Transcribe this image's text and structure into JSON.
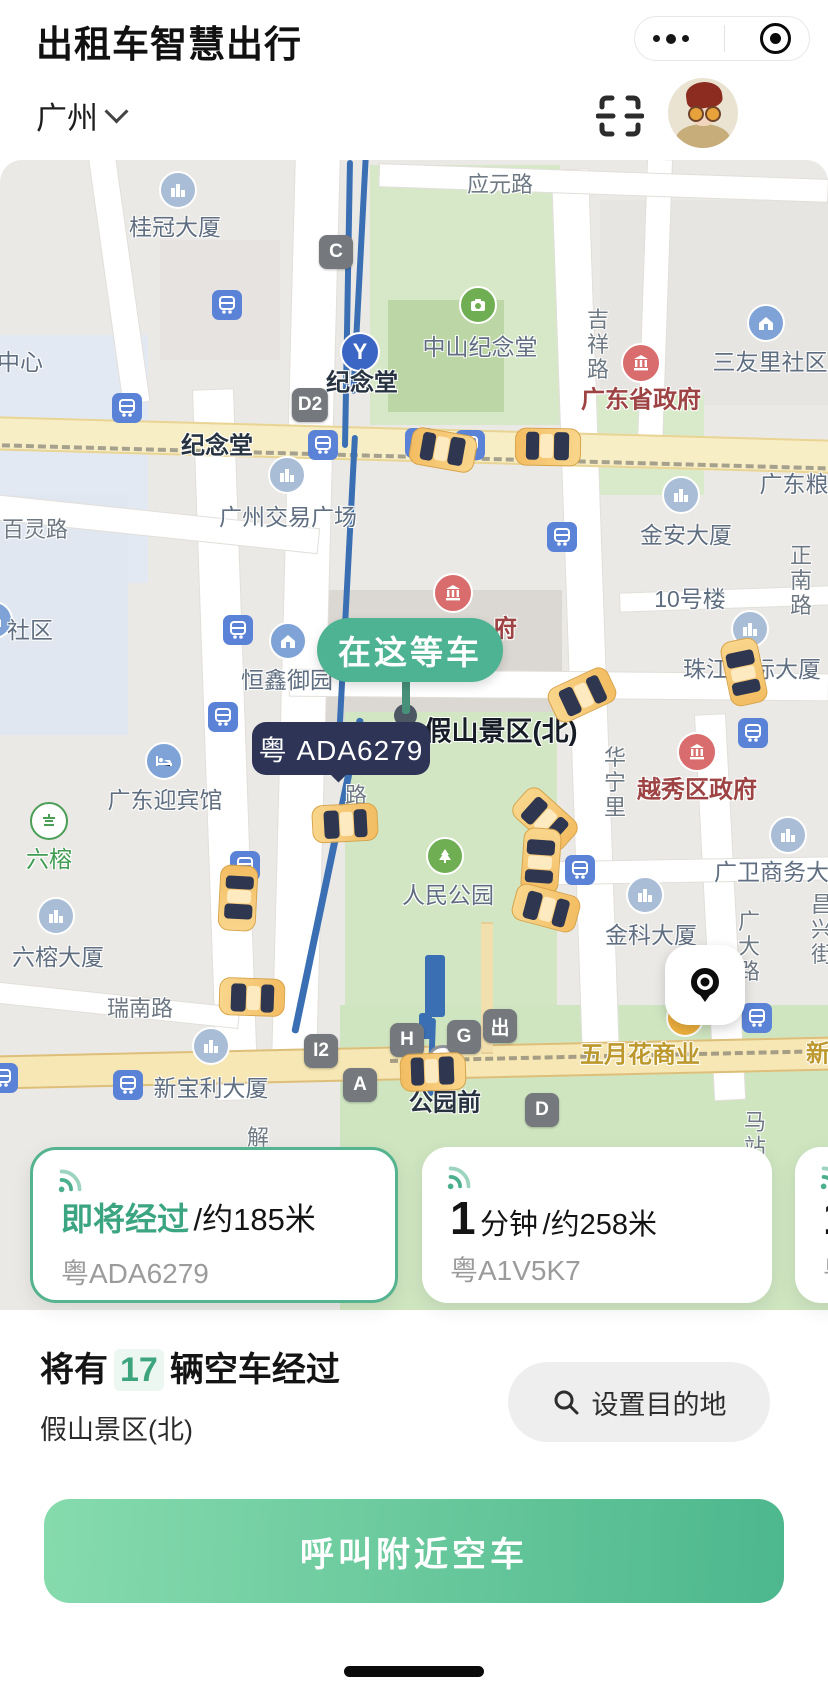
{
  "header": {
    "app_title": "出租车智慧出行",
    "city": "广州",
    "menu_dots": "more-menu",
    "exit_target": "exit-capsule"
  },
  "map": {
    "wait_pill": "在这等车",
    "plate_bubble": "粤 ADA6279",
    "labels": [
      {
        "t": "桂冠大厦",
        "x": 175,
        "y": 65,
        "ty": "poi"
      },
      {
        "t": "中心",
        "x": 20,
        "y": 200,
        "ty": "poi"
      },
      {
        "t": "应元路",
        "x": 500,
        "y": 23,
        "ty": "road"
      },
      {
        "t": "纪念堂",
        "x": 362,
        "y": 220,
        "ty": "station"
      },
      {
        "t": "纪念堂",
        "x": 217,
        "y": 283,
        "ty": "station"
      },
      {
        "t": "中山纪念堂",
        "x": 480,
        "y": 185,
        "ty": "poi"
      },
      {
        "t": "吉祥路",
        "x": 596,
        "y": 185,
        "ty": "road",
        "v": 1
      },
      {
        "t": "广东省政府",
        "x": 641,
        "y": 237,
        "ty": "gov"
      },
      {
        "t": "三友里社区",
        "x": 770,
        "y": 200,
        "ty": "poi"
      },
      {
        "t": "广东粮",
        "x": 794,
        "y": 322,
        "ty": "poi"
      },
      {
        "t": "广州交易广场",
        "x": 288,
        "y": 355,
        "ty": "poi"
      },
      {
        "t": "百灵路",
        "x": 35,
        "y": 368,
        "ty": "road"
      },
      {
        "t": "金安大厦",
        "x": 686,
        "y": 373,
        "ty": "poi"
      },
      {
        "t": "10号楼",
        "x": 690,
        "y": 437,
        "ty": "poi"
      },
      {
        "t": "正南路",
        "x": 799,
        "y": 421,
        "ty": "road",
        "v": 1
      },
      {
        "t": "珠江国际大厦",
        "x": 752,
        "y": 507,
        "ty": "poi"
      },
      {
        "t": "社区",
        "x": 30,
        "y": 468,
        "ty": "poi"
      },
      {
        "t": "恒鑫御园",
        "x": 287,
        "y": 518,
        "ty": "poi"
      },
      {
        "t": "府",
        "x": 505,
        "y": 466,
        "ty": "gov"
      },
      {
        "t": "假山景区(北)",
        "x": 501,
        "y": 569,
        "ty": "big"
      },
      {
        "t": "华宁里",
        "x": 613,
        "y": 623,
        "ty": "road",
        "v": 1
      },
      {
        "t": "越秀区政府",
        "x": 697,
        "y": 627,
        "ty": "gov"
      },
      {
        "t": "广东迎宾馆",
        "x": 165,
        "y": 638,
        "ty": "poi"
      },
      {
        "t": "六榕",
        "x": 49,
        "y": 697,
        "ty": "green"
      },
      {
        "t": "路",
        "x": 354,
        "y": 636,
        "ty": "road",
        "v": 1
      },
      {
        "t": "人民公园",
        "x": 448,
        "y": 733,
        "ty": "poi"
      },
      {
        "t": "广卫商务大厦",
        "x": 783,
        "y": 710,
        "ty": "poi"
      },
      {
        "t": "金科大厦",
        "x": 651,
        "y": 773,
        "ty": "poi"
      },
      {
        "t": "广大路",
        "x": 747,
        "y": 787,
        "ty": "road",
        "v": 1
      },
      {
        "t": "昌兴街",
        "x": 820,
        "y": 770,
        "ty": "road",
        "v": 1
      },
      {
        "t": "六榕大厦",
        "x": 58,
        "y": 795,
        "ty": "poi"
      },
      {
        "t": "瑞南路",
        "x": 140,
        "y": 847,
        "ty": "road"
      },
      {
        "t": "五月花商业",
        "x": 640,
        "y": 892,
        "ty": "gold"
      },
      {
        "t": "新",
        "x": 818,
        "y": 891,
        "ty": "gold"
      },
      {
        "t": "马站",
        "x": 753,
        "y": 975,
        "ty": "road",
        "v": 1
      },
      {
        "t": "新宝利大厦",
        "x": 211,
        "y": 926,
        "ty": "poi"
      },
      {
        "t": "解",
        "x": 258,
        "y": 976,
        "ty": "road"
      },
      {
        "t": "公园前",
        "x": 445,
        "y": 940,
        "ty": "station"
      }
    ],
    "badges": [
      {
        "t": "C",
        "x": 336,
        "y": 92
      },
      {
        "t": "D2",
        "x": 310,
        "y": 245
      },
      {
        "t": "I2",
        "x": 321,
        "y": 891
      },
      {
        "t": "H",
        "x": 407,
        "y": 880
      },
      {
        "t": "G",
        "x": 464,
        "y": 877
      },
      {
        "t": "出",
        "x": 500,
        "y": 866
      },
      {
        "t": "A",
        "x": 360,
        "y": 925
      },
      {
        "t": "D",
        "x": 542,
        "y": 950
      }
    ],
    "icons": [
      {
        "k": "metro",
        "x": 227,
        "y": 145
      },
      {
        "k": "metro",
        "x": 127,
        "y": 248
      },
      {
        "k": "metro",
        "x": 323,
        "y": 285
      },
      {
        "k": "metro",
        "x": 420,
        "y": 283
      },
      {
        "k": "metro",
        "x": 470,
        "y": 285
      },
      {
        "k": "metro",
        "x": 238,
        "y": 470
      },
      {
        "k": "metro",
        "x": 223,
        "y": 557
      },
      {
        "k": "metro",
        "x": 562,
        "y": 377
      },
      {
        "k": "metro",
        "x": 580,
        "y": 710
      },
      {
        "k": "metro",
        "x": 245,
        "y": 706
      },
      {
        "k": "metro",
        "x": 128,
        "y": 925
      },
      {
        "k": "metro",
        "x": 3,
        "y": 918
      },
      {
        "k": "metro",
        "x": 757,
        "y": 858
      },
      {
        "k": "metro",
        "x": 753,
        "y": 573
      },
      {
        "k": "building",
        "x": 178,
        "y": 30
      },
      {
        "k": "building",
        "x": 287,
        "y": 315
      },
      {
        "k": "building",
        "x": 681,
        "y": 335
      },
      {
        "k": "building",
        "x": 750,
        "y": 469
      },
      {
        "k": "building",
        "x": 56,
        "y": 756
      },
      {
        "k": "building",
        "x": 645,
        "y": 735
      },
      {
        "k": "building",
        "x": 788,
        "y": 675
      },
      {
        "k": "building",
        "x": 211,
        "y": 886
      },
      {
        "k": "home",
        "x": 766,
        "y": 163
      },
      {
        "k": "home",
        "x": 288,
        "y": 481
      },
      {
        "k": "home",
        "x": -6,
        "y": 460
      },
      {
        "k": "hotel",
        "x": 164,
        "y": 601
      },
      {
        "k": "camera",
        "x": 478,
        "y": 145
      },
      {
        "k": "tree",
        "x": 445,
        "y": 696
      },
      {
        "k": "temple",
        "x": 49,
        "y": 661
      },
      {
        "k": "gov",
        "x": 641,
        "y": 203
      },
      {
        "k": "gov",
        "x": 697,
        "y": 592
      },
      {
        "k": "gov",
        "x": 453,
        "y": 433
      },
      {
        "k": "bag",
        "x": 685,
        "y": 858
      },
      {
        "k": "mlogo",
        "x": 360,
        "y": 192
      },
      {
        "k": "interchange",
        "x": 443,
        "y": 902
      }
    ],
    "taxis": [
      {
        "x": 443,
        "y": 290,
        "r": 100
      },
      {
        "x": 548,
        "y": 287,
        "r": 91
      },
      {
        "x": 582,
        "y": 535,
        "r": -115
      },
      {
        "x": 744,
        "y": 512,
        "r": -12
      },
      {
        "x": 345,
        "y": 663,
        "r": -93
      },
      {
        "x": 238,
        "y": 738,
        "r": 183
      },
      {
        "x": 252,
        "y": 837,
        "r": -88
      },
      {
        "x": 545,
        "y": 659,
        "r": -48
      },
      {
        "x": 541,
        "y": 701,
        "r": 4
      },
      {
        "x": 546,
        "y": 748,
        "r": -75
      },
      {
        "x": 433,
        "y": 912,
        "r": 88
      }
    ]
  },
  "cards": [
    {
      "status": "即将经过",
      "detail": "/约185米",
      "plate": "粤ADA6279"
    },
    {
      "time_big": "1",
      "time_unit": "分钟",
      "detail": "/约258米",
      "plate": "粤A1V5K7"
    },
    {
      "time_big": "1",
      "time_unit": "分",
      "detail": "",
      "plate": "粤A"
    }
  ],
  "summary": {
    "prefix": "将有",
    "count": "17",
    "suffix": "辆空车经过",
    "location": "假山景区(北)",
    "destination_button": "设置目的地"
  },
  "cta_label": "呼叫附近空车"
}
